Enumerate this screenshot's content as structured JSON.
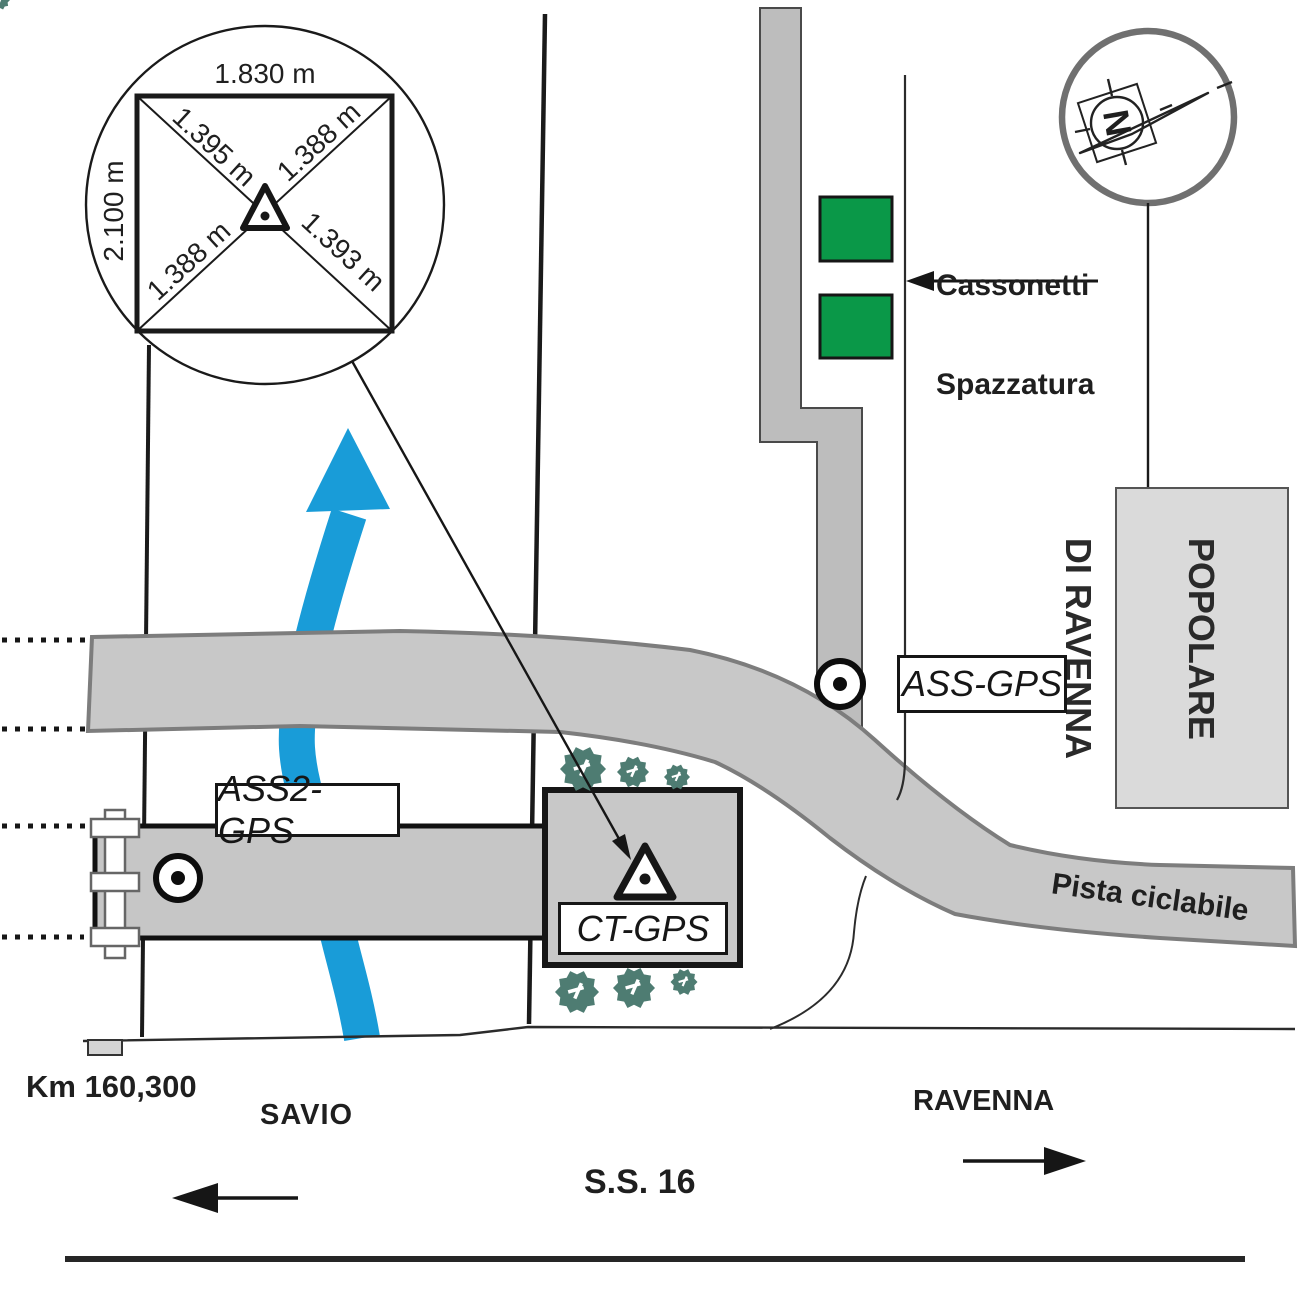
{
  "detail_circle": {
    "top_side": "1.830 m",
    "left_side": "2.100 m",
    "diag_upper_left": "1.395 m",
    "diag_upper_right": "1.388 m",
    "diag_lower_left": "1.388 m",
    "diag_lower_right": "1.393 m"
  },
  "compass": {
    "north_label": "N"
  },
  "landmarks": {
    "bank_line1": "BANCA",
    "bank_line2": "POPOLARE",
    "bank_line3": "DI RAVENNA",
    "bins_line1": "Cassonetti",
    "bins_line2": "Spazzatura",
    "bike_path": "Pista ciclabile"
  },
  "stations": {
    "ass": "ASS-GPS",
    "ass2": "ASS2-GPS",
    "ct": "CT-GPS"
  },
  "road": {
    "km_marker": "Km 160,300",
    "direction_left": "SAVIO",
    "direction_right": "RAVENNA",
    "road_name": "S.S. 16"
  },
  "colors": {
    "river_blue": "#199cd8",
    "bin_green": "#0a9848",
    "path_gray": "#c8c8c8",
    "path_edge_gray": "#7d7d7d",
    "ink": "#1f1f1f"
  }
}
